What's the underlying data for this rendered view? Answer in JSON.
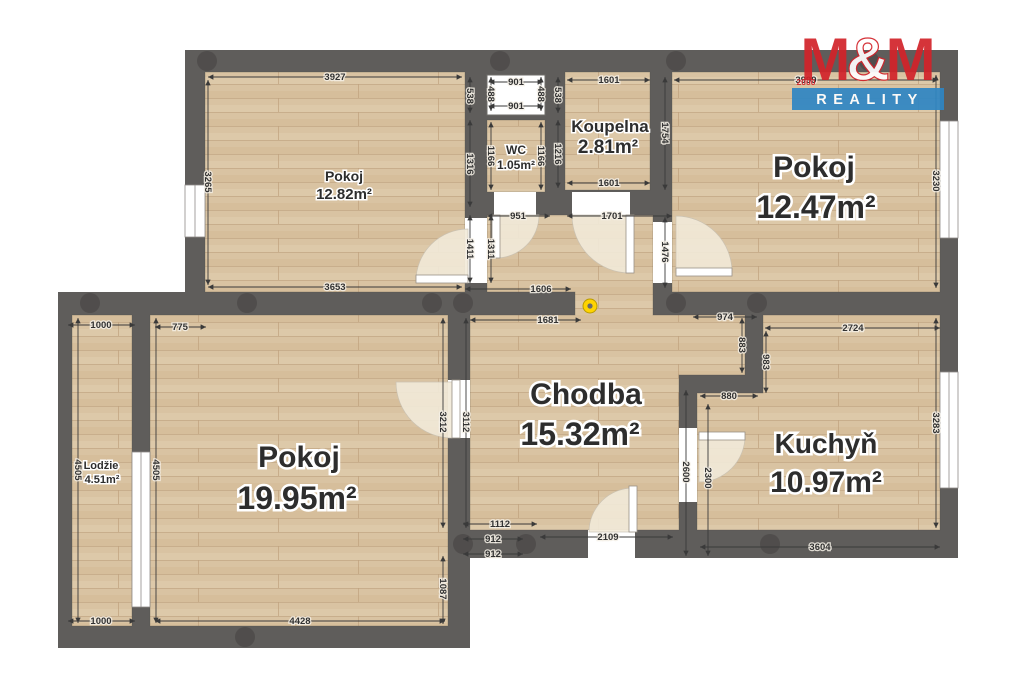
{
  "branding": {
    "m1": "M",
    "amp": "&",
    "m2": "M",
    "year": "2000",
    "reality": "REALITY"
  },
  "rooms": {
    "pokoj1": {
      "name": "Pokoj",
      "area": "12.82m²"
    },
    "wc": {
      "name": "WC",
      "area": "1.05m²"
    },
    "koupelna": {
      "name": "Koupelna",
      "area": "2.81m²"
    },
    "pokoj2": {
      "name": "Pokoj",
      "area": "12.47m²"
    },
    "pokoj3": {
      "name": "Pokoj",
      "area": "19.95m²"
    },
    "chodba": {
      "name": "Chodba",
      "area": "15.32m²"
    },
    "kuchyn": {
      "name": "Kuchyň",
      "area": "10.97m²"
    },
    "lodzie": {
      "name": "Lodžie",
      "area": "4.51m²"
    }
  },
  "dims": {
    "room1_top": "3927",
    "room1_left": "3265",
    "room1_bottom": "3653",
    "room1_right_upper": "538",
    "room1_right_mid": "1316",
    "room1_door_in": "1411",
    "room1_door_out": "1311",
    "shaft_top": "901",
    "shaft_bottom": "901",
    "shaft_left": "488",
    "shaft_right": "488",
    "wc_left": "1166",
    "wc_right": "1166",
    "wc_door": "951",
    "koup_top": "1601",
    "koup_bottom": "1601",
    "koup_left_upper": "538",
    "koup_left_lower": "1216",
    "koup_right": "1754",
    "koup_door": "1701",
    "room2_top": "3999",
    "room2_right": "3230",
    "room2_door": "1476",
    "chodba_wall_top": "1606",
    "chodba_wall_bottom": "1681",
    "chodba_left": "3112",
    "nook_top": "974",
    "nook_side": "883",
    "nook_bottom": "880",
    "kuchyn_top": "2724",
    "kuchyn_left": "983",
    "kuchyn_wall": "2600",
    "kuchyn_door": "2300",
    "kuchyn_right": "3283",
    "kuchyn_bottom": "3604",
    "entry_top": "1112",
    "entry_mid": "912",
    "entry_bottom": "912",
    "entry_door": "2109",
    "lodzie_top": "1000",
    "lodzie_bottom": "1000",
    "lodzie_left": "4505",
    "room3_top": "775",
    "room3_left": "4505",
    "room3_right_upper": "3212",
    "room3_right_lower": "1087",
    "room3_bottom": "4428"
  },
  "colors": {
    "wall": "#5f5d5b",
    "wall_joint": "#4c4a48",
    "floor": "#d9c3a2",
    "floor_stripe": "#c6ab88",
    "door_arc": "#f2ead9",
    "logo_red": "#d2232a",
    "logo_blue": "#2f86c4",
    "marker_yellow": "#ffd400"
  }
}
